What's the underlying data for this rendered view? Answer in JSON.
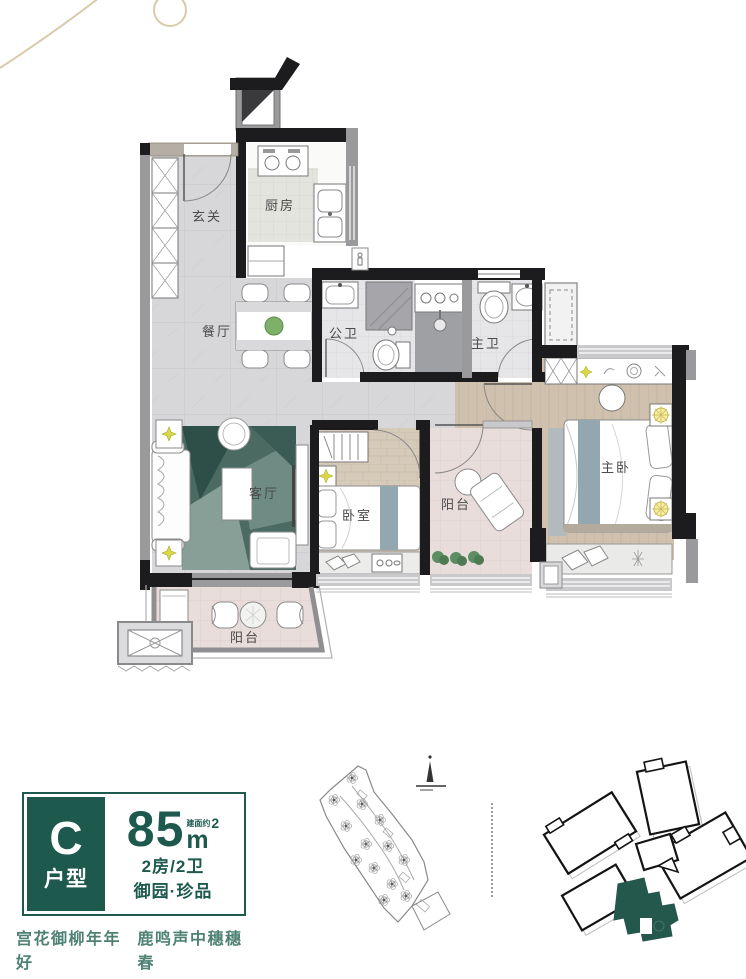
{
  "plan": {
    "labels": {
      "entry": "玄关",
      "kitchen": "厨房",
      "dining": "餐厅",
      "public_bath": "公卫",
      "master_bath": "主卫",
      "living": "客厅",
      "bedroom": "卧室",
      "balcony_middle": "阳台",
      "master_bedroom": "主卧",
      "balcony_bottom": "阳台"
    }
  },
  "badge": {
    "type_letter": "C",
    "type_label": "户型",
    "area_value": "85",
    "area_note": "建面约",
    "area_unit": "m",
    "area_sup": "2",
    "rooms_baths": "2房/2卫",
    "series": "御园·珍品"
  },
  "slogan": {
    "left": "宫花御柳年年好",
    "right": "鹿鸣声中穗穗春"
  },
  "colors": {
    "brand_green": "#1d594d",
    "highlight_unit": "#24584c",
    "slogan_green": "#4e8173",
    "decor_gold": "#d9cbaa",
    "wall_black": "#1c1c1e",
    "wall_gray": "#9a9a9c"
  }
}
